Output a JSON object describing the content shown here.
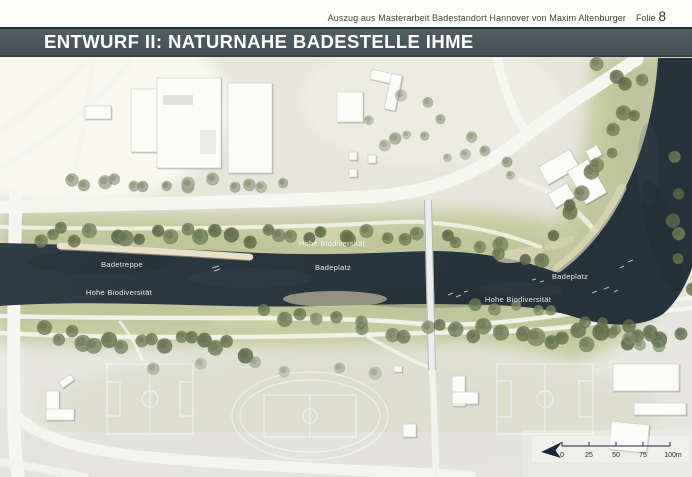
{
  "header": {
    "source_note": "Auszug aus Masterarbeit Badestandort Hannover von Maxim Altenburger",
    "slide_label": "Folie",
    "slide_number": "8"
  },
  "title_bar": {
    "title": "ENTWURF II: NATURNAHE BADESTELLE IHME",
    "bg_color": "#47535a",
    "text_color": "#ffffff"
  },
  "map": {
    "labels": [
      {
        "text": "Hohe Biodiversität",
        "x": 332,
        "y": 246
      },
      {
        "text": "Badetreppe",
        "x": 122,
        "y": 267
      },
      {
        "text": "Badeplatz",
        "x": 333,
        "y": 270
      },
      {
        "text": "Badeplatz",
        "x": 570,
        "y": 279
      },
      {
        "text": "Hohe Biodiversität",
        "x": 119,
        "y": 295
      },
      {
        "text": "Hohe Biodiversität",
        "x": 518,
        "y": 302
      }
    ],
    "scale_bar": {
      "tick_labels": [
        "0",
        "25",
        "50",
        "75",
        "100m"
      ]
    },
    "north_arrow_icon": "north-arrow-icon",
    "colors": {
      "water": "#2d3a43",
      "water_deep": "#1f2a31",
      "bank_green": "#c6cba2",
      "ground": "#e7e7df",
      "road": "#f6f6f1",
      "sand": "#e8e1c8",
      "building": "#fbfbf9",
      "label_text": "#f2f3ee",
      "scale_text": "#17293b"
    }
  }
}
